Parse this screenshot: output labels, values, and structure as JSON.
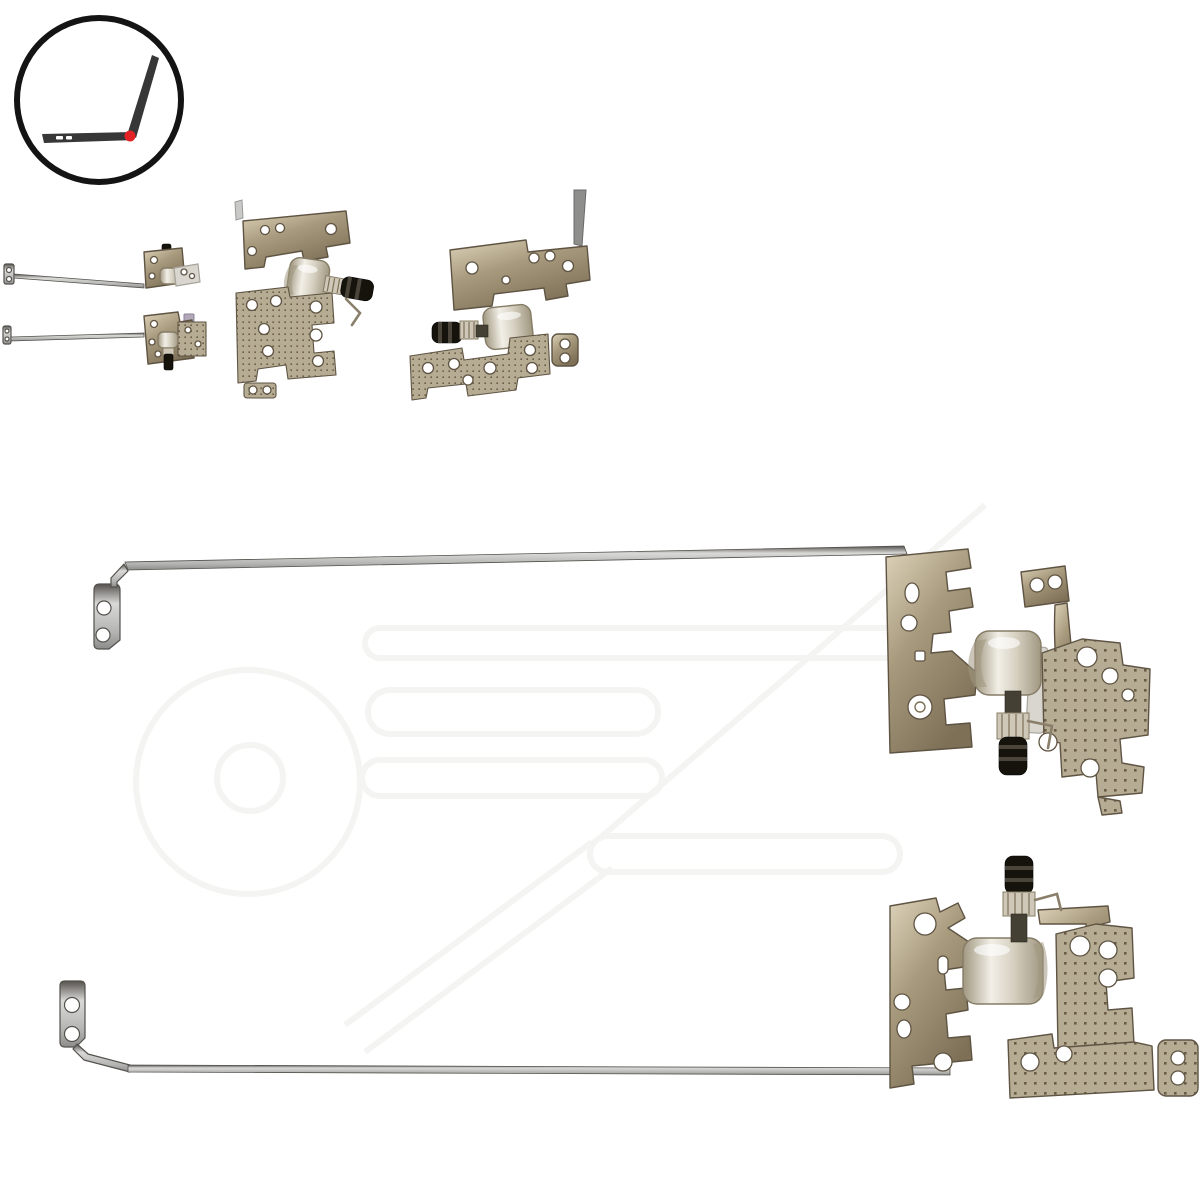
{
  "canvas": {
    "background": "#ffffff"
  },
  "brand_logo": {
    "icon": "open-laptop-side-view-icon",
    "ring_color": "#141414",
    "laptop_color": "#373737",
    "hinge_dot_color": "#e32226"
  },
  "gallery": {
    "thumbnails": [
      {
        "name": "hinge-pair-with-rails-thumbnail"
      },
      {
        "name": "right-hinge-bracket-closeup-thumbnail"
      },
      {
        "name": "left-hinge-bracket-closeup-thumbnail"
      }
    ]
  },
  "product_photos": [
    {
      "name": "right-lcd-hinge-with-rail",
      "parts": [
        "mounting-tab",
        "display-rail",
        "hinge-bracket",
        "hinge-barrel",
        "captive-screw-axle",
        "perforated-mounting-plate"
      ]
    },
    {
      "name": "left-lcd-hinge-with-rail",
      "parts": [
        "mounting-tab",
        "display-rail",
        "hinge-bracket",
        "hinge-barrel",
        "captive-screw-axle",
        "perforated-mounting-plate"
      ]
    }
  ],
  "colors": {
    "bg": "#ffffff",
    "metal_hi": "#ddd3ba",
    "metal_mid": "#a89a7d",
    "metal_low": "#7d7057",
    "metal_edge": "#5f5443",
    "rail": "#b3b3b1",
    "rail_hi": "#d9d9d7",
    "rail_low": "#8c8c8a",
    "rail_edge": "#55524d",
    "barrel_hi": "#f2efe7",
    "barrel_mid": "#d7d1c2",
    "barrel_low": "#a09780",
    "barrel_edge": "#857c66",
    "screw_dark": "#16130d",
    "screw_mid": "#454034",
    "knurl": "#cfc8b8",
    "hole": "#ffffff",
    "perf_base": "#b6ac94",
    "perf_dot": "#695d46",
    "logo_ring": "#141414",
    "logo_laptop": "#373737",
    "logo_dot": "#e32226",
    "watermark": "#f4f4f2",
    "silver": "#d9d6cf",
    "silver_edge": "#a8a49b"
  }
}
